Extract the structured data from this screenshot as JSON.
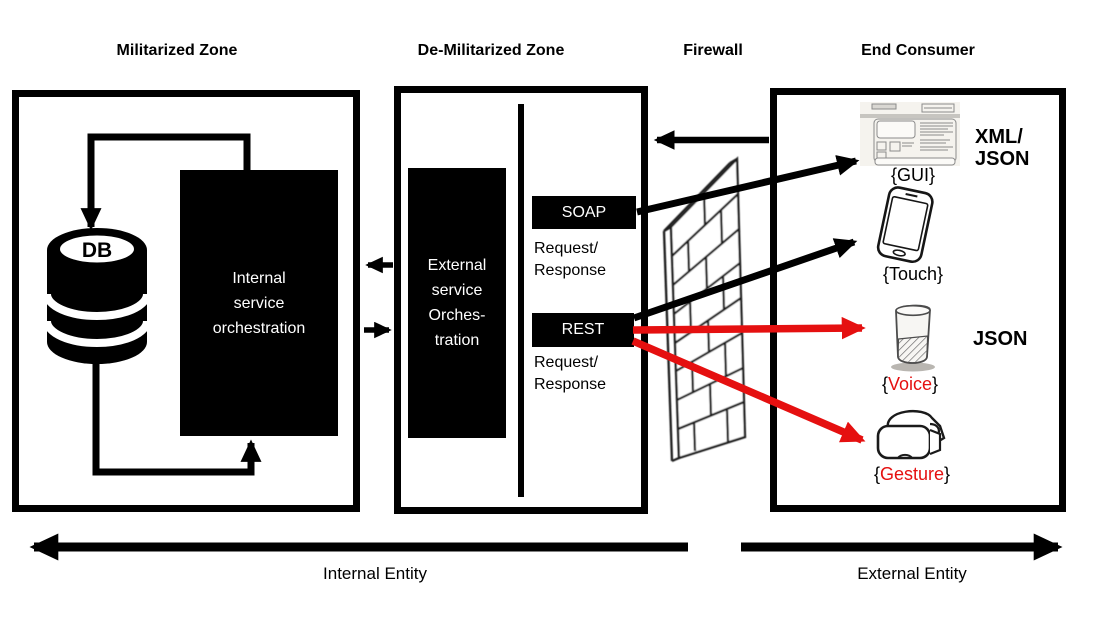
{
  "titles": {
    "militarized_zone": "Militarized Zone",
    "demilitarized_zone": "De-Militarized Zone",
    "firewall": "Firewall",
    "end_consumer": "End Consumer"
  },
  "militarized_zone": {
    "db_label": "DB",
    "internal_orchestration_lines": [
      "Internal",
      "service",
      "orchestration"
    ]
  },
  "demilitarized_zone": {
    "external_orchestration_lines": [
      "External",
      "service",
      "Orches-",
      "tration"
    ],
    "soap_label": "SOAP",
    "soap_caption_lines": [
      "Request/",
      "Response"
    ],
    "rest_label": "REST",
    "rest_caption_lines": [
      "Request/",
      "Response"
    ]
  },
  "end_consumer": {
    "brace_open": "{",
    "brace_close": "}",
    "channels": [
      {
        "name": "GUI"
      },
      {
        "name": "Touch"
      },
      {
        "name": "Voice"
      },
      {
        "name": "Gesture"
      }
    ],
    "xml_json_lines": [
      "XML/",
      "JSON"
    ],
    "json_label": "JSON"
  },
  "footer": {
    "internal_entity_label": "Internal Entity",
    "external_entity_label": "External Entity"
  },
  "colors": {
    "diagram_black": "#000000",
    "highlight_red": "#e51010"
  }
}
